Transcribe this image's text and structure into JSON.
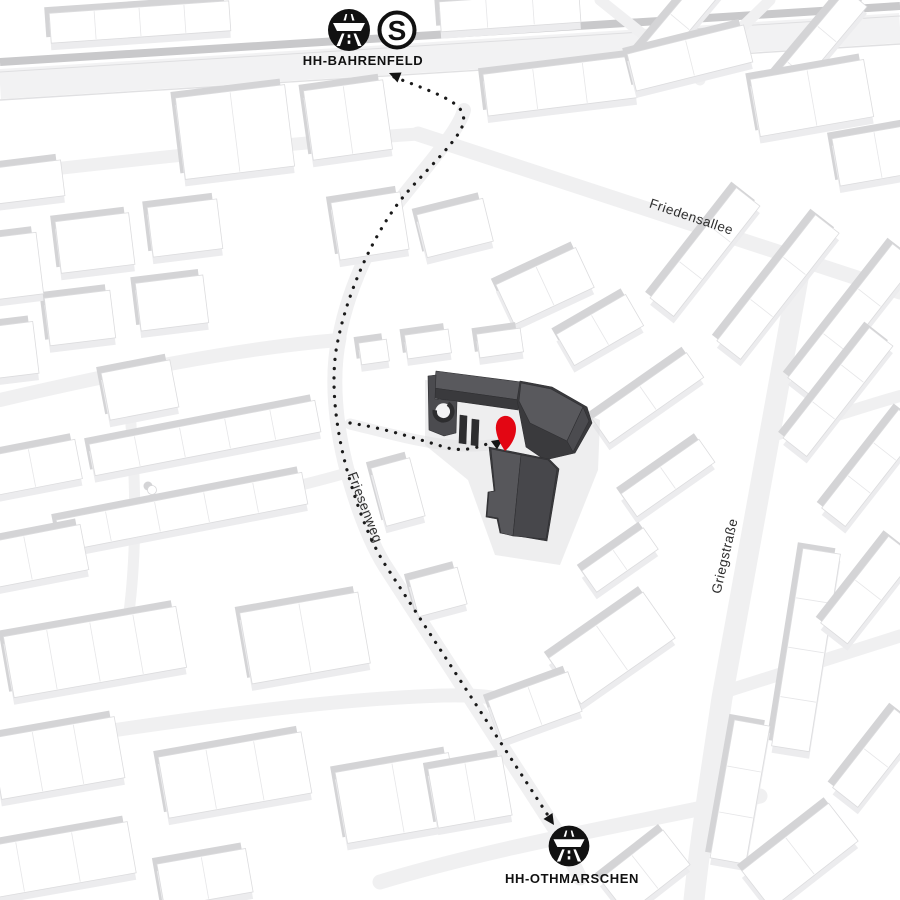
{
  "map": {
    "stations": [
      {
        "id": "hh-bahrenfeld",
        "label": "HH-BAHRENFELD",
        "icons": [
          "autobahn-icon",
          "sbahn-icon"
        ]
      },
      {
        "id": "hh-othmarschen",
        "label": "HH-OTHMARSCHEN",
        "icons": [
          "autobahn-icon"
        ]
      }
    ],
    "streets": [
      {
        "name": "Friedensallee"
      },
      {
        "name": "Friesenweg"
      },
      {
        "name": "Griegstraße"
      }
    ],
    "sbahn_letter": "S",
    "marker_color": "#e30613",
    "highlight_building_color": "#3a3a3d",
    "route_style": "dotted"
  }
}
